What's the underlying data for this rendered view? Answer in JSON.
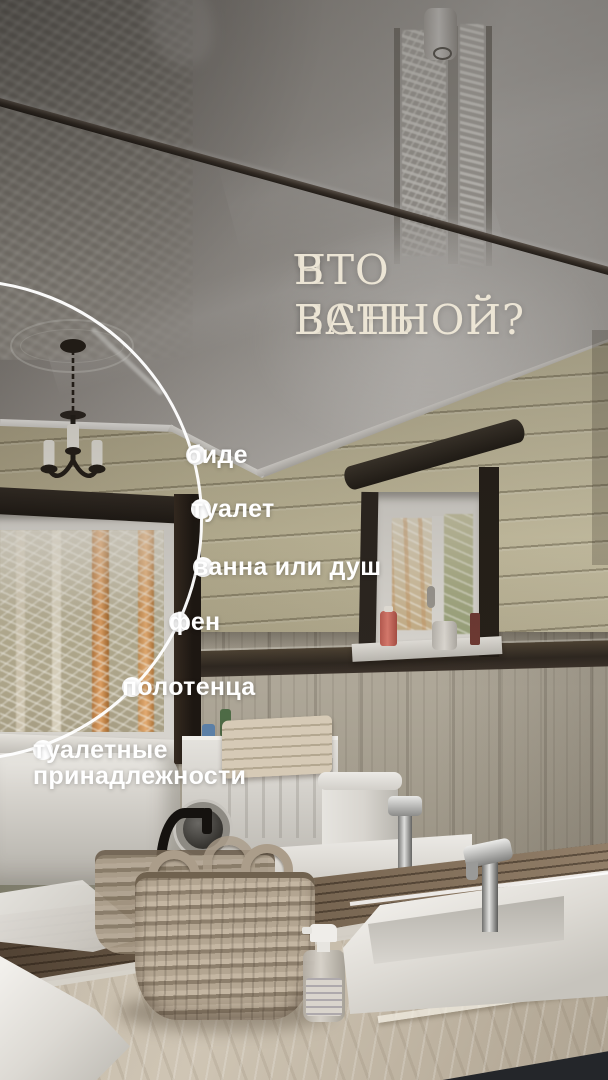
{
  "overlay": {
    "title": {
      "line1": "ЧТО ЕСТЬ",
      "line2": "В ВАННОЙ?"
    },
    "checklist": [
      {
        "label": "биде"
      },
      {
        "label": "туалет"
      },
      {
        "label": "ванна или душ"
      },
      {
        "label": "фен"
      },
      {
        "label": "полотенца"
      },
      {
        "label": "туалетные принадлежности"
      }
    ]
  },
  "colors": {
    "title_text": "#ece5d5",
    "callout_text": "#ffffff",
    "guide_line": "#ffffff",
    "wall_wood": "#c4bc9d",
    "dark_trim": "#2e2720",
    "counter": "#cfc5b4"
  }
}
